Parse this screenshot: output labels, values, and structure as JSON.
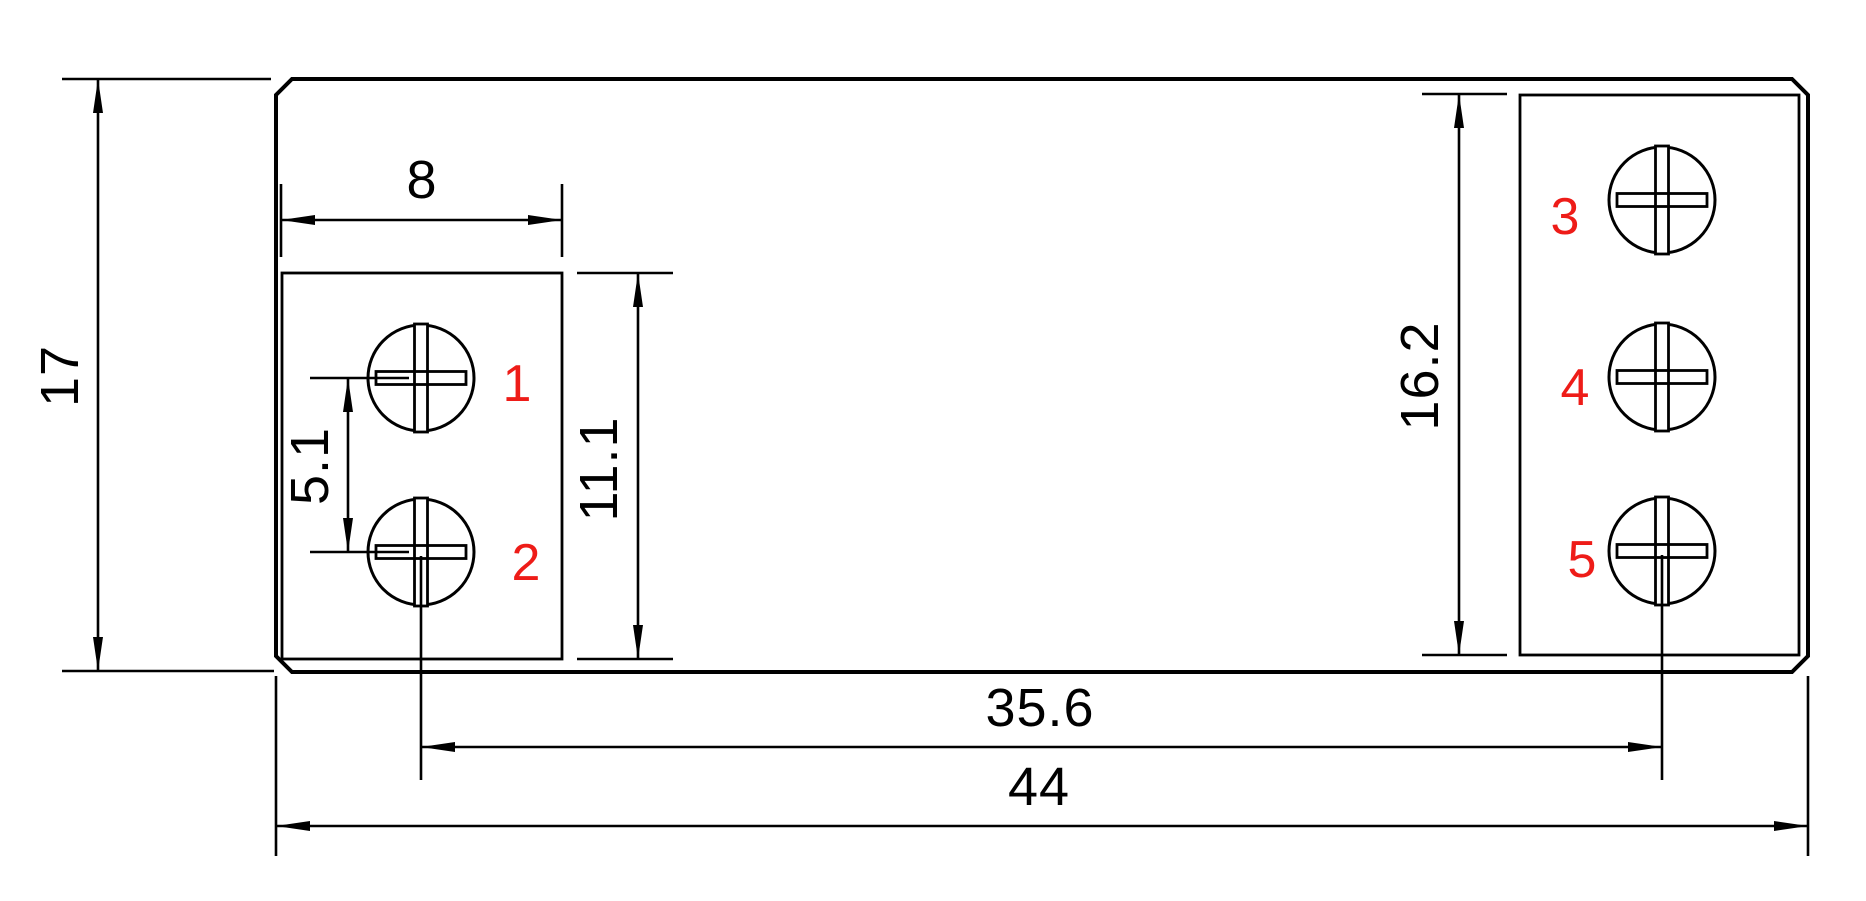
{
  "drawing": {
    "type": "technical-dimension-drawing",
    "subject": "terminal block module top view with five screw terminals"
  },
  "colors": {
    "line": "#000000",
    "accent": "#ee1c18",
    "background": "#ffffff"
  },
  "dims": {
    "overall_height": "17",
    "left_block_width": "8",
    "left_hole_pitch": "5.1",
    "left_block_height": "11.1",
    "right_block_height": "16.2",
    "hole_span": "35.6",
    "overall_width": "44"
  },
  "terminals": [
    "1",
    "2",
    "3",
    "4",
    "5"
  ]
}
